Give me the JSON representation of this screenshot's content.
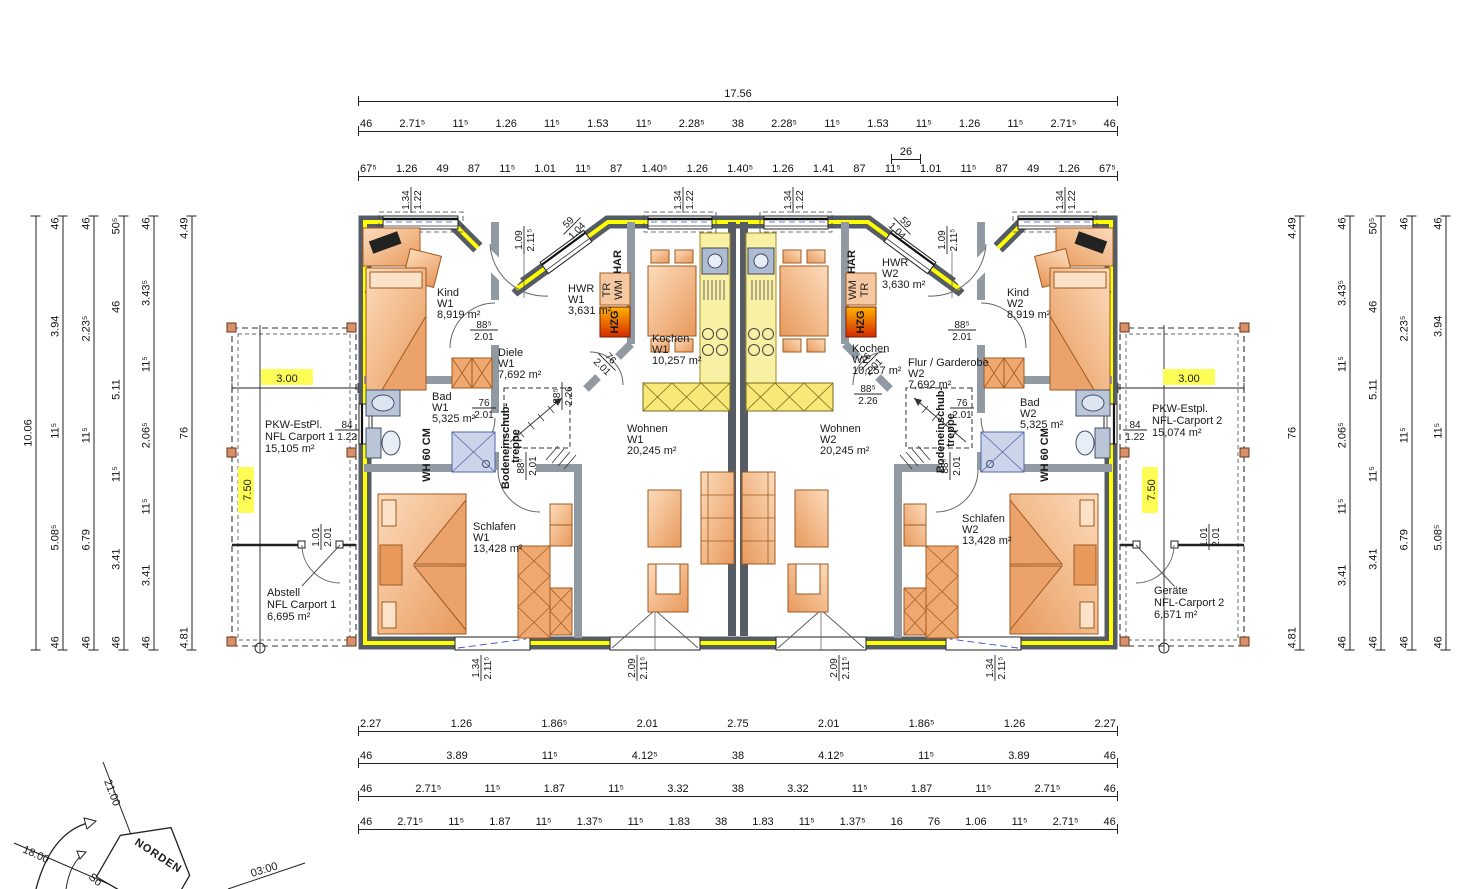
{
  "rooms": {
    "kind_w1": {
      "name": "Kind",
      "unit": "W1",
      "area": "8,919 m²"
    },
    "hwr_w1": {
      "name": "HWR",
      "unit": "W1",
      "area": "3,631 m²"
    },
    "diele_w1": {
      "name": "Diele",
      "unit": "W1",
      "area": "7,692 m²"
    },
    "kochen_w1": {
      "name": "Kochen",
      "unit": "W1",
      "area": "10,257 m²"
    },
    "bad_w1": {
      "name": "Bad",
      "unit": "W1",
      "area": "5,325 m²"
    },
    "schlafen_w1": {
      "name": "Schlafen",
      "unit": "W1",
      "area": "13,428 m²"
    },
    "wohnen_w1": {
      "name": "Wohnen",
      "unit": "W1",
      "area": "20,245 m²"
    },
    "kind_w2": {
      "name": "Kind",
      "unit": "W2",
      "area": "8,919 m²"
    },
    "hwr_w2": {
      "name": "HWR",
      "unit": "W2",
      "area": "3,630 m²"
    },
    "flur_w2": {
      "name": "Flur / Garderobe",
      "unit": "W2",
      "area": "7,692 m²"
    },
    "kochen_w2": {
      "name": "Kochen",
      "unit": "W2",
      "area": "10,257 m²"
    },
    "bad_w2": {
      "name": "Bad",
      "unit": "W2",
      "area": "5,325 m²"
    },
    "schlafen_w2": {
      "name": "Schlafen",
      "unit": "W2",
      "area": "13,428 m²"
    },
    "wohnen_w2": {
      "name": "Wohnen",
      "unit": "W2",
      "area": "20,245 m²"
    }
  },
  "carports": {
    "pkw1": {
      "line1": "PKW-EstPl.",
      "line2": "NFL Carport 1",
      "area": "15,105 m²"
    },
    "abstell1": {
      "line1": "Abstell",
      "line2": "NFL Carport 1",
      "area": "6,695 m²"
    },
    "pkw2": {
      "line1": "PKW-Estpl.",
      "line2": "NFL-Carport 2",
      "area": "15,074 m²"
    },
    "geraete2": {
      "line1": "Geräte",
      "line2": "NFL-Carport 2",
      "area": "6,671 m²"
    },
    "width_dim": "3.00",
    "depth_dim": "7.50"
  },
  "annotations": {
    "har": "HAR",
    "tr": "TR",
    "wm": "WM",
    "hzg": "HZG",
    "wall_hint": "WH 60 CM",
    "attic1": "Bodeneinschub-",
    "attic2": "treppe"
  },
  "fracs": {
    "door_big": {
      "n": "88⁵",
      "d": "2.01"
    },
    "door_small": {
      "n": "76",
      "d": "2.01"
    },
    "opening": {
      "n": "88⁵",
      "d": "2.26"
    },
    "win_side": {
      "n": "84",
      "d": "1.22"
    },
    "win_top": {
      "n": "1.34",
      "d": "1.22"
    },
    "entry": {
      "n": "1.09",
      "d": "2.11⁵"
    },
    "win_diag": {
      "n": "59",
      "d": "1.04"
    },
    "terr_small": {
      "n": "1.34",
      "d": "2.11⁵"
    },
    "terr_big": {
      "n": "2.09",
      "d": "2.11⁵"
    },
    "cp_door": {
      "n": "1.01",
      "d": "2.01"
    }
  },
  "dims": {
    "top_total": "17.56",
    "top_row2": [
      "46",
      "2.71⁵",
      "11⁵",
      "1.26",
      "11⁵",
      "1.53",
      "11⁵",
      "2.28⁵",
      "38",
      "2.28⁵",
      "11⁵",
      "1.53",
      "11⁵",
      "1.26",
      "11⁵",
      "2.71⁵",
      "46"
    ],
    "top_row3": [
      "67⁵",
      "1.26",
      "49",
      "87",
      "11⁵",
      "1.01",
      "11⁵",
      "87",
      "1.40⁵",
      "1.26",
      "1.40⁵",
      "1.26",
      "1.41",
      "87",
      "11⁵",
      "1.01",
      "11⁵",
      "87",
      "49",
      "1.26",
      "67⁵"
    ],
    "top_small": "26",
    "bottom_row1": [
      "2.27",
      "1.26",
      "1.86⁵",
      "2.01",
      "2.75",
      "2.01",
      "1.86⁵",
      "1.26",
      "2.27"
    ],
    "bottom_row2": [
      "46",
      "3.89",
      "11⁵",
      "4.12⁵",
      "38",
      "4.12⁵",
      "11⁵",
      "3.89",
      "46"
    ],
    "bottom_row3": [
      "46",
      "2.71⁵",
      "11⁵",
      "1.87",
      "11⁵",
      "3.32",
      "38",
      "3.32",
      "11⁵",
      "1.87",
      "11⁵",
      "2.71⁵",
      "46"
    ],
    "bottom_row4": [
      "46",
      "2.71⁵",
      "11⁵",
      "1.87",
      "11⁵",
      "1.37⁵",
      "11⁵",
      "1.83",
      "38",
      "1.83",
      "11⁵",
      "1.37⁵",
      "16",
      "76",
      "1.06",
      "11⁵",
      "2.71⁵",
      "46"
    ],
    "left_total": "10.06",
    "left_2": [
      "46",
      "3.94",
      "11⁵",
      "5.08⁵",
      "46"
    ],
    "left_3": [
      "46",
      "2.23⁵",
      "11⁵",
      "6.79",
      "46"
    ],
    "left_4": [
      "50⁵",
      "46",
      "5.11",
      "11⁵",
      "3.41",
      "46"
    ],
    "left_5": [
      "46",
      "3.43⁵",
      "11⁵",
      "2.06⁵",
      "11⁵",
      "3.41",
      "46"
    ],
    "left_inner": [
      "4.49",
      "76",
      "4.81"
    ],
    "right_inner": [
      "4.49",
      "76",
      "4.81"
    ],
    "right_5": [
      "46",
      "3.43⁵",
      "11⁵",
      "2.06⁵",
      "11⁵",
      "3.41",
      "46"
    ],
    "right_4": [
      "50⁵",
      "46",
      "5.11",
      "11⁵",
      "3.41",
      "46"
    ],
    "right_3": [
      "46",
      "2.23⁵",
      "11⁵",
      "6.79",
      "46"
    ],
    "right_2": [
      "46",
      "3.94",
      "11⁵",
      "5.08⁵",
      "46"
    ]
  },
  "compass": {
    "norden": "NORDEN",
    "t2100": "21:00",
    "t1800": "18:00",
    "t0300": "03:00",
    "sun": "So"
  },
  "colors": {
    "wall": "#565c66",
    "inner_wall": "#9199a3",
    "insulation": "#ffff00",
    "highlight": "#fdfd55",
    "furniture": "#f6c8a2",
    "kitchen": "#f8f0a2",
    "hzg": "#e03000"
  }
}
